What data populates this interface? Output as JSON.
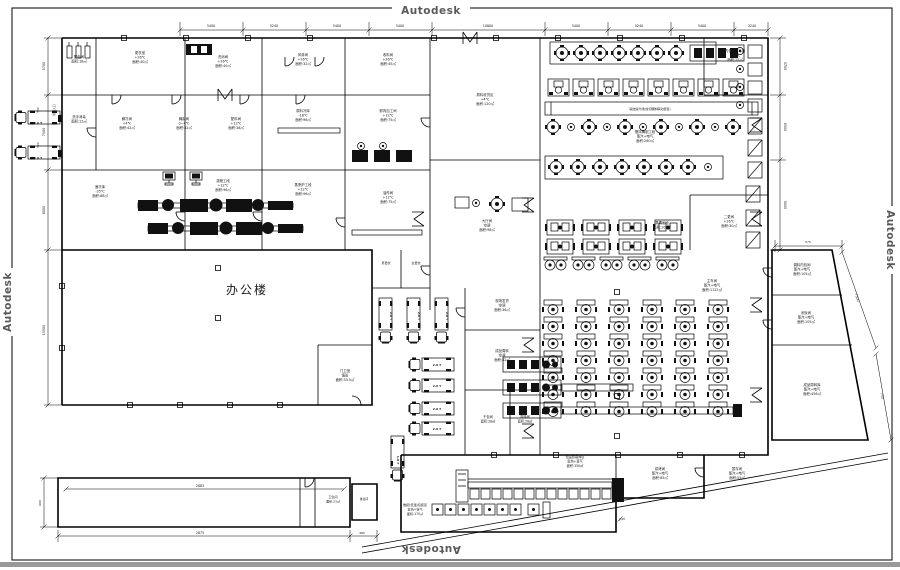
{
  "drawing": {
    "application_watermark": "Autodesk",
    "main_room": "办公楼",
    "accent_color": "#111111",
    "watermark_color": "#5a5a5a"
  },
  "labels": [
    {
      "t": "Autodesk",
      "x": 431,
      "y": 14,
      "s": 10.5,
      "b": 1,
      "c": "#5a5a5a",
      "sp": 0.5,
      "n": "watermark-top"
    },
    {
      "t": "Autodesk",
      "x": 431,
      "y": 546,
      "s": 10.5,
      "b": 1,
      "c": "#5a5a5a",
      "sp": 0.5,
      "r": 180,
      "n": "watermark-bottom"
    },
    {
      "t": "Autodesk",
      "x": 11,
      "y": 302,
      "s": 10.5,
      "b": 1,
      "c": "#5a5a5a",
      "sp": 0.5,
      "r": -90,
      "n": "watermark-left"
    },
    {
      "t": "Autodesk",
      "x": 887,
      "y": 240,
      "s": 10.5,
      "b": 1,
      "c": "#5a5a5a",
      "sp": 0.5,
      "r": 90,
      "n": "watermark-right"
    },
    {
      "t": "办公楼",
      "x": 247,
      "y": 294,
      "s": 12,
      "sp": 2,
      "n": "office-building-label"
    },
    {
      "t": "5400",
      "x": 211,
      "y": 27,
      "s": 3.3,
      "n": "dim"
    },
    {
      "t": "5240",
      "x": 274,
      "y": 27,
      "s": 3.3,
      "n": "dim"
    },
    {
      "t": "5400",
      "x": 337,
      "y": 27,
      "s": 3.3,
      "n": "dim"
    },
    {
      "t": "5400",
      "x": 400,
      "y": 27,
      "s": 3.3,
      "n": "dim"
    },
    {
      "t": "10800",
      "x": 488,
      "y": 27,
      "s": 3.3,
      "n": "dim"
    },
    {
      "t": "5400",
      "x": 576,
      "y": 27,
      "s": 3.3,
      "n": "dim"
    },
    {
      "t": "5240",
      "x": 639,
      "y": 27,
      "s": 3.3,
      "n": "dim"
    },
    {
      "t": "5400",
      "x": 702,
      "y": 27,
      "s": 3.3,
      "n": "dim"
    },
    {
      "t": "3240",
      "x": 752,
      "y": 27,
      "s": 3.3,
      "n": "dim"
    },
    {
      "t": "5700",
      "x": 45,
      "y": 66,
      "s": 3.3,
      "r": -90,
      "n": "dim"
    },
    {
      "t": "7500",
      "x": 45,
      "y": 132,
      "s": 3.3,
      "r": -90,
      "n": "dim"
    },
    {
      "t": "8000",
      "x": 45,
      "y": 210,
      "s": 3.3,
      "r": -90,
      "n": "dim"
    },
    {
      "t": "15500",
      "x": 45,
      "y": 330,
      "s": 3.3,
      "r": -90,
      "n": "dim"
    },
    {
      "t": "500",
      "x": 39,
      "y": 110,
      "s": 2.8,
      "r": -90,
      "n": "dim"
    },
    {
      "t": "500",
      "x": 39,
      "y": 145,
      "s": 2.8,
      "r": -90,
      "n": "dim"
    },
    {
      "t": "5700",
      "x": 784,
      "y": 66,
      "s": 3.3,
      "r": 90,
      "n": "dim"
    },
    {
      "t": "6500",
      "x": 784,
      "y": 127,
      "s": 3.3,
      "r": 90,
      "n": "dim"
    },
    {
      "t": "9000",
      "x": 784,
      "y": 205,
      "s": 3.3,
      "r": 90,
      "n": "dim"
    },
    {
      "t": "575",
      "x": 808,
      "y": 243,
      "s": 3,
      "n": "dim"
    },
    {
      "t": "7500",
      "x": 856,
      "y": 298,
      "s": 3.3,
      "r": 71,
      "n": "dim"
    },
    {
      "t": "750",
      "x": 881,
      "y": 396,
      "s": 3,
      "r": 80,
      "n": "dim"
    },
    {
      "t": "2883",
      "x": 200,
      "y": 487,
      "s": 3.3,
      "n": "dim"
    },
    {
      "t": "2875",
      "x": 200,
      "y": 534,
      "s": 3.3,
      "n": "dim"
    },
    {
      "t": "380",
      "x": 362,
      "y": 534,
      "s": 3,
      "n": "dim"
    },
    {
      "t": "600",
      "x": 41,
      "y": 503,
      "s": 3,
      "r": -90,
      "n": "dim"
    },
    {
      "t": "1685",
      "x": 622,
      "y": 520,
      "s": 2.8,
      "r": -6,
      "n": "dim"
    },
    {
      "ls": [
        "配电间",
        "面积:18㎡"
      ],
      "x": 79,
      "y": 58,
      "s": 3.4,
      "n": "room-label"
    },
    {
      "ls": [
        "更衣室",
        "+26℃",
        "面积:40㎡"
      ],
      "x": 140,
      "y": 54,
      "s": 3.4,
      "n": "room-label"
    },
    {
      "ls": [
        "洗消间",
        "+26℃",
        "面积:40㎡"
      ],
      "x": 223,
      "y": 58,
      "s": 3.4,
      "n": "room-label"
    },
    {
      "ls": [
        "风淋间",
        "+26℃",
        "面积:32㎡"
      ],
      "x": 303,
      "y": 56,
      "s": 3.4,
      "n": "room-label"
    },
    {
      "ls": [
        "收料间",
        "+26℃",
        "面积:45㎡"
      ],
      "x": 388,
      "y": 56,
      "s": 3.4,
      "n": "room-label"
    },
    {
      "ls": [
        "内包材消毒间",
        "+26℃",
        "面积:25㎡"
      ],
      "x": 735,
      "y": 52,
      "s": 3.4,
      "n": "room-label"
    },
    {
      "ls": [
        "洗手消毒",
        "面积:12㎡"
      ],
      "x": 79,
      "y": 118,
      "s": 3.4,
      "n": "room-label"
    },
    {
      "ls": [
        "解冻间",
        "+4℃",
        "面积:42㎡"
      ],
      "x": 127,
      "y": 120,
      "s": 3.4,
      "n": "room-label"
    },
    {
      "ls": [
        "腌制间",
        "0~4℃",
        "面积:42㎡"
      ],
      "x": 184,
      "y": 120,
      "s": 3.4,
      "n": "room-label"
    },
    {
      "ls": [
        "配料间",
        "+12℃",
        "面积:38㎡"
      ],
      "x": 236,
      "y": 120,
      "s": 3.4,
      "n": "room-label"
    },
    {
      "ls": [
        "原料冷库",
        "-18℃",
        "面积:96㎡"
      ],
      "x": 303,
      "y": 112,
      "s": 3.4,
      "n": "room-label"
    },
    {
      "ls": [
        "鲜肉加工间",
        "+12℃",
        "面积:75㎡"
      ],
      "x": 388,
      "y": 112,
      "s": 3.4,
      "n": "room-label"
    },
    {
      "ls": [
        "速冻库",
        "-35℃",
        "面积:88㎡"
      ],
      "x": 100,
      "y": 188,
      "s": 3.4,
      "n": "room-label"
    },
    {
      "ls": [
        "灌肠工段",
        "+12℃",
        "面积:96㎡"
      ],
      "x": 223,
      "y": 182,
      "s": 3.4,
      "n": "room-label"
    },
    {
      "ls": [
        "蒸熏炉工段",
        "+12℃",
        "面积:96㎡"
      ],
      "x": 303,
      "y": 186,
      "s": 3.4,
      "n": "room-label"
    },
    {
      "ls": [
        "油炸间",
        "+12℃",
        "面积:75㎡"
      ],
      "x": 388,
      "y": 194,
      "s": 3.4,
      "n": "room-label"
    },
    {
      "ls": [
        "原料收货区",
        "+4℃",
        "面积:120㎡"
      ],
      "x": 485,
      "y": 96,
      "s": 3.4,
      "n": "room-label"
    },
    {
      "ls": [
        "大厅间",
        "空调",
        "面积:98㎡"
      ],
      "x": 487,
      "y": 222,
      "s": 3.4,
      "n": "room-label"
    },
    {
      "t": "男更衣",
      "x": 386,
      "y": 264,
      "s": 3,
      "n": "room-label"
    },
    {
      "t": "女更衣",
      "x": 416,
      "y": 264,
      "s": 3,
      "n": "room-label"
    },
    {
      "ls": [
        "现场发货",
        "空调",
        "面积:36㎡"
      ],
      "x": 502,
      "y": 302,
      "s": 3.4,
      "n": "room-label"
    },
    {
      "ls": [
        "成品周转",
        "空调",
        "面积:42㎡"
      ],
      "x": 502,
      "y": 352,
      "s": 3.4,
      "n": "room-label"
    },
    {
      "ls": [
        "干包间",
        "面积:28㎡"
      ],
      "x": 488,
      "y": 418,
      "s": 3.2,
      "n": "room-label"
    },
    {
      "ls": [
        "周转间",
        "面积:28㎡"
      ],
      "x": 525,
      "y": 418,
      "s": 3.2,
      "n": "room-label"
    },
    {
      "ls": [
        "主车间",
        "蒸汽+电气",
        "面积:1122㎡"
      ],
      "x": 712,
      "y": 282,
      "s": 3.4,
      "n": "room-label"
    },
    {
      "ls": [
        "搅拌腌制工段",
        "蒸汽+电气",
        "面积:260㎡"
      ],
      "x": 645,
      "y": 133,
      "s": 3.4,
      "n": "room-label"
    },
    {
      "t": "输送提升线(绞切腌制联动装置)",
      "x": 650,
      "y": 110,
      "s": 3,
      "n": "machine-label"
    },
    {
      "ls": [
        "蒸煮工段",
        "面积:108㎡"
      ],
      "x": 662,
      "y": 224,
      "s": 3.4,
      "n": "room-label"
    },
    {
      "ls": [
        "二更间",
        "+26℃",
        "面积:30㎡"
      ],
      "x": 729,
      "y": 218,
      "s": 3.4,
      "n": "room-label"
    },
    {
      "ls": [
        "调料内包间",
        "蒸汽+电气",
        "面积:105㎡"
      ],
      "x": 802,
      "y": 266,
      "s": 3.4,
      "n": "room-label"
    },
    {
      "ls": [
        "米饭间",
        "蒸汽+电气",
        "面积:105㎡"
      ],
      "x": 806,
      "y": 314,
      "s": 3.4,
      "n": "room-label"
    },
    {
      "ls": [
        "成品周转库",
        "蒸汽+电气",
        "面积:456㎡"
      ],
      "x": 812,
      "y": 386,
      "s": 3.4,
      "n": "room-label"
    },
    {
      "ls": [
        "恒温包装间区",
        "复热+蒸气",
        "面积:350㎡"
      ],
      "x": 575,
      "y": 458,
      "s": 3.2,
      "n": "room-label"
    },
    {
      "ls": [
        "散装(低温)包装区",
        "复热+蒸气",
        "面积:170㎡"
      ],
      "x": 415,
      "y": 506,
      "s": 3.1,
      "n": "room-label"
    },
    {
      "ls": [
        "烘烤间",
        "蒸汽+电气",
        "面积:85㎡"
      ],
      "x": 660,
      "y": 470,
      "s": 3.4,
      "n": "room-label"
    },
    {
      "ls": [
        "暂存间",
        "蒸汽+电气",
        "面积:55㎡"
      ],
      "x": 737,
      "y": 470,
      "s": 3.4,
      "n": "room-label"
    },
    {
      "ls": [
        "门卫室",
        "值班",
        "面积:33.5㎡"
      ],
      "x": 345,
      "y": 372,
      "s": 3.4,
      "n": "room-label"
    },
    {
      "ls": [
        "卫生间",
        "面积:23㎡"
      ],
      "x": 333,
      "y": 498,
      "s": 3,
      "n": "room-label"
    },
    {
      "t": "淋浴间",
      "x": 364,
      "y": 500,
      "s": 2.8,
      "n": "room-label"
    },
    {
      "t": "原料入口",
      "x": 55,
      "y": 110,
      "s": 2.8,
      "r": -90,
      "n": "dock-label"
    },
    {
      "t": "2.0 T",
      "x": 38,
      "y": 124,
      "s": 3,
      "b": 1,
      "n": "truck-label"
    },
    {
      "t": "2.0 T",
      "x": 38,
      "y": 159,
      "s": 3,
      "b": 1,
      "n": "truck-label"
    },
    {
      "t": "2.0 T",
      "x": 390,
      "y": 316,
      "s": 3,
      "b": 1,
      "r": 90,
      "n": "truck-label"
    },
    {
      "t": "2.0 T",
      "x": 418,
      "y": 316,
      "s": 3,
      "b": 1,
      "r": 90,
      "n": "truck-label"
    },
    {
      "t": "2.0 T",
      "x": 446,
      "y": 316,
      "s": 3,
      "b": 1,
      "r": 90,
      "n": "truck-label"
    },
    {
      "t": "2.0 T",
      "x": 437,
      "y": 366,
      "s": 3,
      "b": 1,
      "n": "truck-label"
    },
    {
      "t": "2.0 T",
      "x": 437,
      "y": 387,
      "s": 3,
      "b": 1,
      "n": "truck-label"
    },
    {
      "t": "2.0 T",
      "x": 437,
      "y": 410,
      "s": 3,
      "b": 1,
      "n": "truck-label"
    },
    {
      "t": "2.0 T",
      "x": 437,
      "y": 430,
      "s": 3,
      "b": 1,
      "n": "truck-label"
    },
    {
      "t": "1.0 T",
      "x": 397,
      "y": 460,
      "s": 3,
      "b": 1,
      "r": 90,
      "n": "truck-label"
    }
  ]
}
